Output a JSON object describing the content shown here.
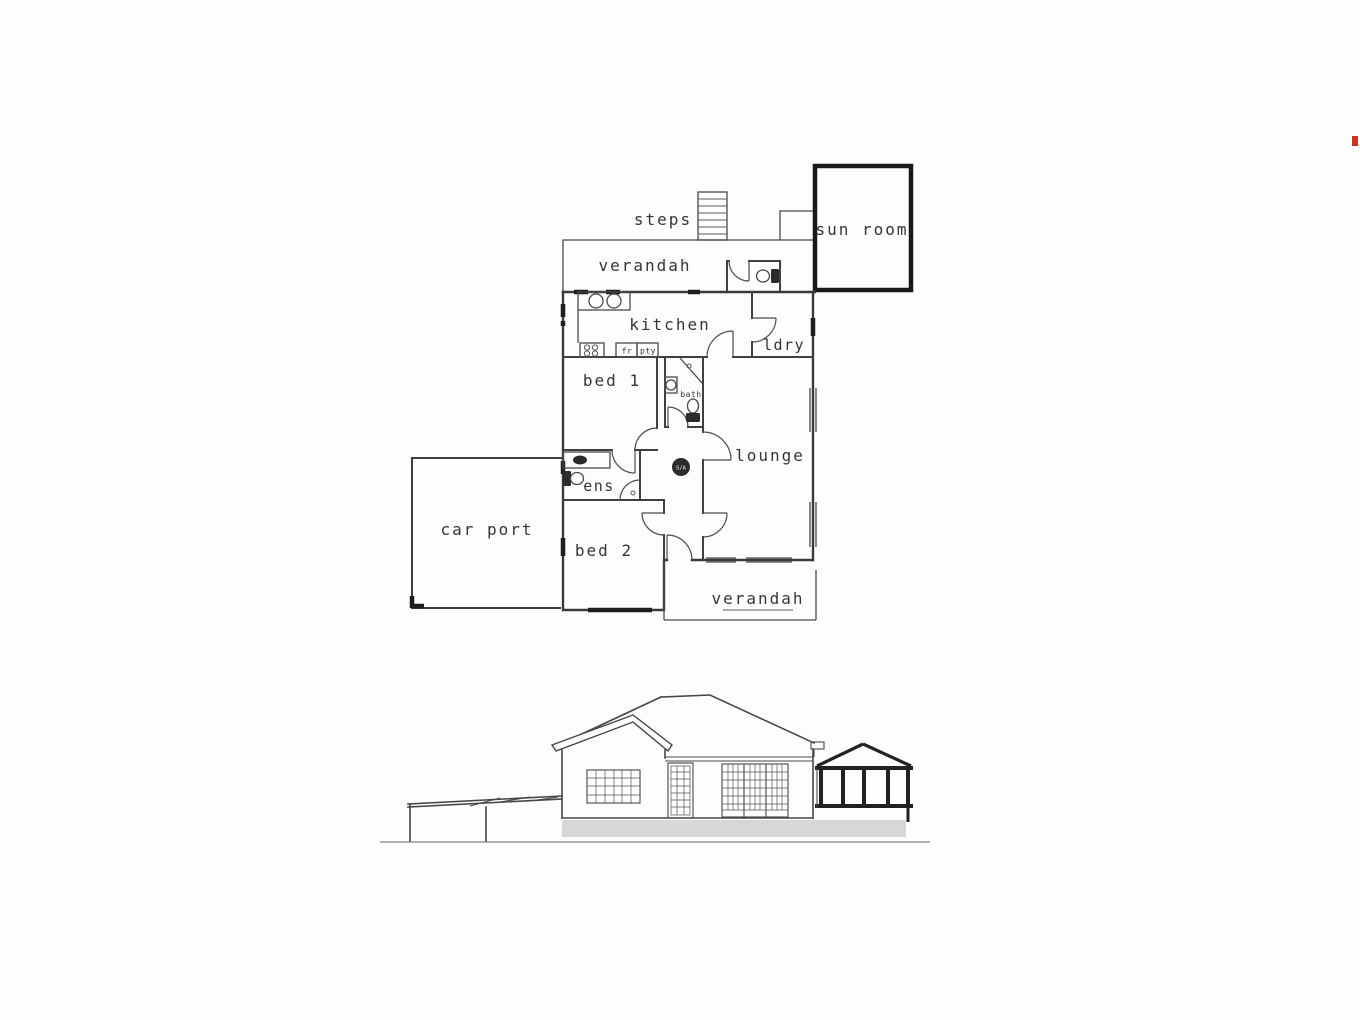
{
  "document": {
    "kind": "scanned house plans: floor plan and side elevation"
  },
  "floor_plan": {
    "labels": {
      "steps": "steps",
      "sun_room": "sun room",
      "verandah_top": "verandah",
      "kitchen": "kitchen",
      "fridge": "fr",
      "pantry": "pty",
      "laundry": "ldry",
      "bed1": "bed 1",
      "bath": "bath",
      "lounge": "lounge",
      "ens": "ens",
      "bed2": "bed 2",
      "car_port": "car port",
      "verandah_bottom": "verandah",
      "smoke_alarm": "S/A"
    }
  },
  "colors": {
    "ink": "#3a3a3a",
    "heavy_wall": "#191919",
    "plinth_grey": "#d7d7d5",
    "ground_grey": "#9a9a9a",
    "edge_artifact_red": "#cc3027"
  }
}
